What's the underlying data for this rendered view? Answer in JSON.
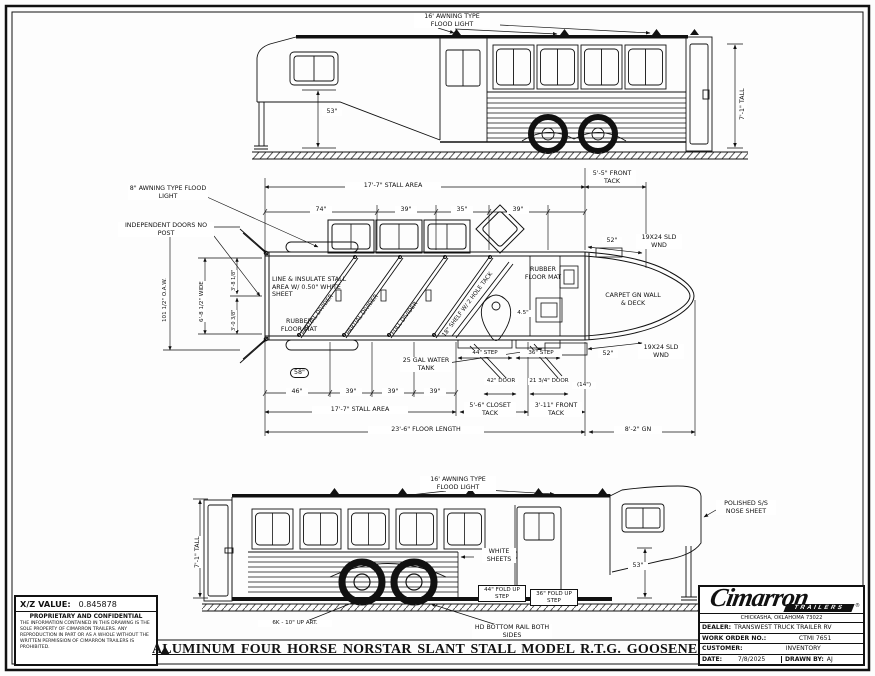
{
  "sheet": {
    "title": "ALUMINUM FOUR HORSE NORSTAR SLANT STALL MODEL R.T.G. GOOSENECK TRAILER"
  },
  "xz_block": {
    "label": "X/Z VALUE:",
    "value": "0.845878",
    "confidential_title": "PROPRIETARY AND CONFIDENTIAL",
    "confidential_body": "THE INFORMATION CONTAINED IN THIS DRAWING IS THE SOLE PROPERTY OF CIMARRON TRAILERS. ANY REPRODUCTION IN PART OR AS A WHOLE WITHOUT THE WRITTEN PERMISSION OF CIMARRON TRAILERS IS PROHIBITED."
  },
  "title_block": {
    "brand": "Cimarron",
    "brand_banner": "TRAILERS",
    "reg": "®",
    "address": "CHICKASHA, OKLAHOMA 73022",
    "dealer_label": "DEALER:",
    "dealer_value": "TRANSWEST TRUCK TRAILER RV",
    "work_order_label": "WORK ORDER NO.:",
    "work_order_value": "CTMI 7651",
    "customer_label": "CUSTOMER:",
    "customer_value": "INVENTORY",
    "date_label": "DATE:",
    "date_value": "7/8/2025",
    "drawn_by_label": "DRAWN BY:",
    "drawn_by_value": "AJ"
  },
  "top_view": {
    "flood_light": "16' AWNING TYPE FLOOD LIGHT",
    "dim_53": "53\"",
    "dim_tall": "7'-1\" TALL"
  },
  "plan_view": {
    "awning_light": "8\" AWNING TYPE FLOOD LIGHT",
    "independent_doors": "INDEPENDENT DOORS NO POST",
    "dim_oaw": "101 1/2\" O.A.W.",
    "dim_wide": "6'-8 1/2\" WIDE",
    "dim_rear_1": "3'-8 1/8\"",
    "dim_rear_2": "3'-0 3/8\"",
    "dim_stall_top": "17'-7\" STALL AREA",
    "dim_front_tack_top": "5'-5\" FRONT TACK",
    "dim_74": "74\"",
    "dim_39a": "39\"",
    "dim_35": "35\"",
    "dim_39b": "39\"",
    "note_insulate": "LINE & INSULATE STALL AREA W/ 0.50\" WHITE SHEET",
    "note_rubber_left": "RUBBER FLOOR MAT",
    "divider_partial_1": "PARTIAL DIVIDER",
    "divider_partial_2": "PARTIAL DIVIDER",
    "divider_full": "FULL DIVIDER",
    "note_shelf": "18\" SHELF W/ 2 HOLE TACK",
    "note_rubber_right": "RUBBER FLOOR MAT",
    "note_carpet": "CARPET GN WALL & DECK",
    "note_water_tank": "25 GAL WATER TANK",
    "dim_52_top": "52\"",
    "wnd_top": "19X24 SLD WND",
    "dim_52_bottom": "52\"",
    "wnd_bottom": "19X24 SLD WND",
    "dim_step_44": "44\" STEP",
    "dim_step_36": "36\" STEP",
    "dim_door_42": "42\" DOOR",
    "dim_door_21": "21 3/4\" DOOR",
    "dim_14": "(14\")",
    "dim_45": "4.5\"",
    "dim_58": "58\"",
    "dim_46": "46\"",
    "dim_39c": "39\"",
    "dim_39d": "39\"",
    "dim_39e": "39\"",
    "dim_stall_bottom": "17'-7\" STALL AREA",
    "dim_closet_tack": "5'-6\" CLOSET TACK",
    "dim_front_tack_bottom": "3'-11\" FRONT TACK",
    "dim_floor_length": "23'-6\" FLOOR LENGTH",
    "dim_gn": "8'-2\" GN"
  },
  "bottom_view": {
    "flood_light": "16' AWNING TYPE FLOOD LIGHT",
    "dim_tall": "7'-1\" TALL",
    "note_white_sheets": "WHITE SHEETS",
    "step_44": "44\" FOLD UP STEP",
    "step_36": "36\" FOLD UP STEP",
    "note_bottom_rail": "HD BOTTOM RAIL BOTH SIDES",
    "note_axle": "6K - 10\" UP ART.",
    "note_nose": "POLISHED S/S NOSE SHEET",
    "dim_53": "53\""
  }
}
